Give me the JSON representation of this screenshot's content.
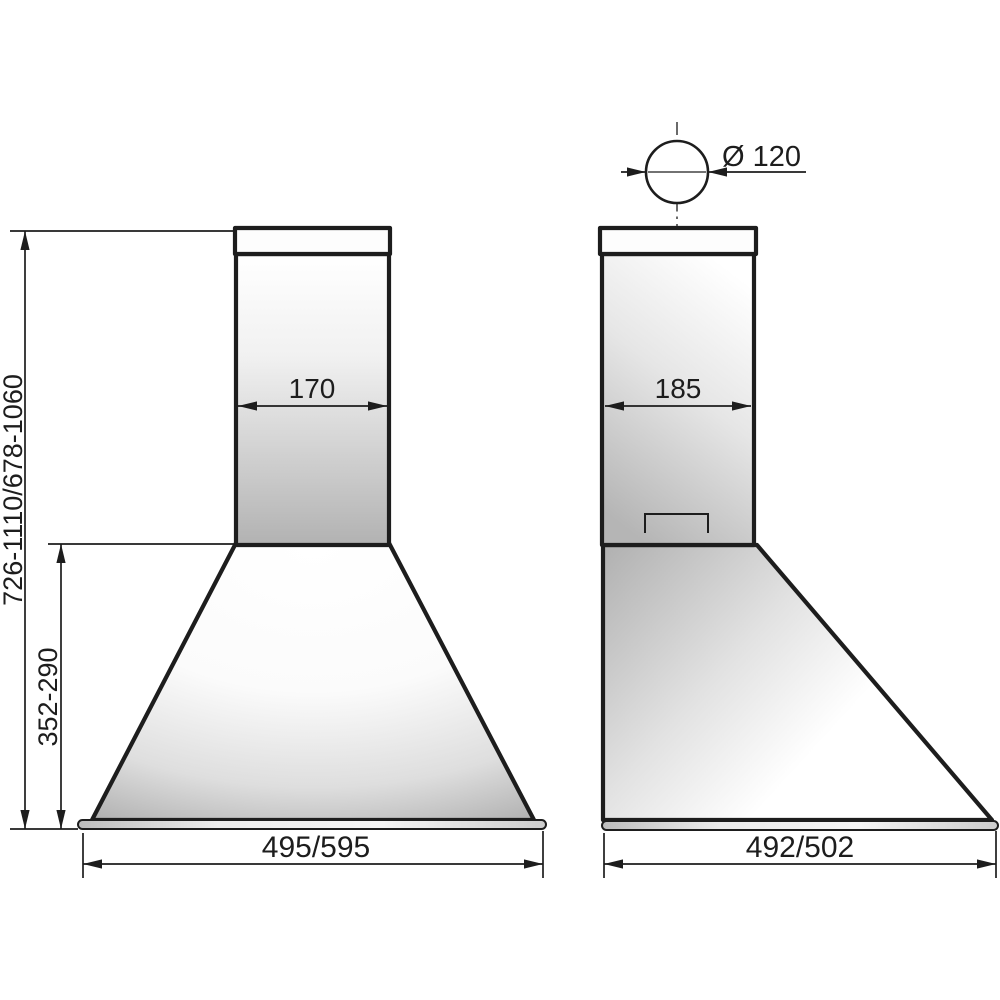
{
  "drawing": {
    "kind": "technical-dimension-drawing",
    "subject": "chimney cooker hood, front and side elevation with dimensions in mm",
    "views": {
      "front": {
        "chimney_width": "170",
        "base_width": "495/595",
        "overall_height": "726-1110/678-1060",
        "canopy_height": "352-290"
      },
      "side": {
        "duct_diameter": "Ø 120",
        "chimney_depth": "185",
        "base_depth": "492/502"
      }
    },
    "colors": {
      "line": "#1d1d1d",
      "background": "#ffffff",
      "shade_light": "#ffffff",
      "shade_dark": "#aaaaaa"
    }
  }
}
